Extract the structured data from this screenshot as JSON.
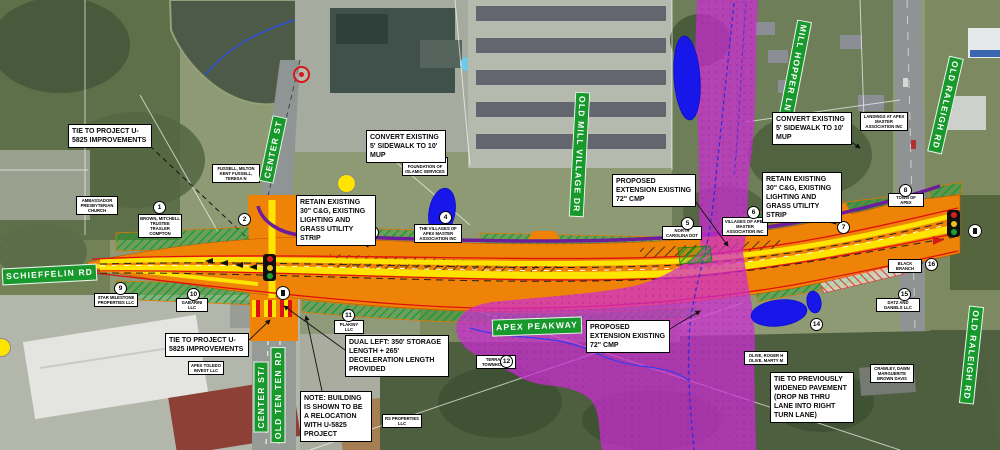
{
  "map": {
    "title": "Apex Peakway Widening Plan",
    "corridor": "APEX PEAKWAY"
  },
  "street_labels": [
    {
      "id": "center-st-north",
      "text": "CENTER ST"
    },
    {
      "id": "schieffelin-rd",
      "text": "SCHIEFFELIN RD"
    },
    {
      "id": "old-mill-village-dr",
      "text": "OLD MILL VILLAGE DR"
    },
    {
      "id": "mill-hopper-ln",
      "text": "MILL HOPPER LN"
    },
    {
      "id": "old-raleigh-rd-north",
      "text": "OLD RALEIGH RD"
    },
    {
      "id": "old-raleigh-rd-south",
      "text": "OLD RALEIGH RD"
    },
    {
      "id": "center-st-south",
      "text": "CENTER ST/"
    },
    {
      "id": "old-ten-ten-rd",
      "text": "OLD TEN TEN RD"
    },
    {
      "id": "apex-peakway",
      "text": "APEX PEAKWAY"
    }
  ],
  "callouts": [
    {
      "id": "tie-u5825-nw",
      "text": "TIE TO PROJECT U-5825 IMPROVEMENTS"
    },
    {
      "id": "convert-sidewalk-west",
      "text": "CONVERT EXISTING 5' SIDEWALK TO 10' MUP"
    },
    {
      "id": "retain-cg-west",
      "text": "RETAIN EXISTING 30\" C&G, EXISTING LIGHTING AND GRASS UTILITY STRIP"
    },
    {
      "id": "proposed-ext-north",
      "text": "PROPOSED EXTENSION EXISTING 72\" CMP"
    },
    {
      "id": "retain-cg-east",
      "text": "RETAIN EXISTING 30\" C&G, EXISTING LIGHTING AND GRASS UTILITY STRIP"
    },
    {
      "id": "convert-sidewalk-east",
      "text": "CONVERT EXISTING 5' SIDEWALK TO 10' MUP"
    },
    {
      "id": "tie-u5825-sw",
      "text": "TIE TO PROJECT U-5825 IMPROVEMENTS"
    },
    {
      "id": "dual-left",
      "text": "DUAL LEFT: 350' STORAGE LENGTH + 265' DECELERATION LENGTH PROVIDED"
    },
    {
      "id": "note-building",
      "text": "NOTE: BUILDING IS SHOWN TO BE A RELOCATION WITH U-5825 PROJECT"
    },
    {
      "id": "proposed-ext-south",
      "text": "PROPOSED EXTENSION EXISTING 72\" CMP"
    },
    {
      "id": "tie-widened",
      "text": "TIE TO PREVIOUSLY WIDENED PAVEMENT (DROP NB THRU LANE INTO RIGHT TURN LANE)"
    }
  ],
  "markers": [
    {
      "n": "1"
    },
    {
      "n": "2"
    },
    {
      "n": "3"
    },
    {
      "n": "4"
    },
    {
      "n": "5"
    },
    {
      "n": "6"
    },
    {
      "n": "7"
    },
    {
      "n": "8"
    },
    {
      "n": "9"
    },
    {
      "n": "10"
    },
    {
      "n": "11"
    },
    {
      "n": "12"
    },
    {
      "n": "13"
    },
    {
      "n": "14"
    },
    {
      "n": "15"
    },
    {
      "n": "16"
    }
  ],
  "parcels": [
    {
      "text": "AMBASSADOR PRESBYTERIAN CHURCH"
    },
    {
      "text": "FUSSELL, MILTON KENT FUSSELL, TERESA N"
    },
    {
      "text": "BROWN, MITCHELL TRUSTEE TRAXLER COMPTON"
    },
    {
      "text": "MADISON REALTY LLC"
    },
    {
      "text": "NORTH AMERICAN FOUNDATION OF ISLAMIC SERVICES"
    },
    {
      "text": "THE VILLAGES OF APEX MASTER ASSOCIATION INC"
    },
    {
      "text": "NORTH CAROLINA DOT"
    },
    {
      "text": "VILLAGES OF APEX MASTER ASSOCIATION INC"
    },
    {
      "text": "TOWN OF APEX"
    },
    {
      "text": "LANDINGS AT APEX MASTER ASSOCIATION INC"
    },
    {
      "text": "BLACK BRANCH"
    },
    {
      "text": "STAR MILESTONE PROPERTIES LLC"
    },
    {
      "text": "GABARINI LLC"
    },
    {
      "text": "PLAKINY LLC"
    },
    {
      "text": "APEX TOLEDO INVEST LLC"
    },
    {
      "text": "RS PROPERTIES LLC"
    },
    {
      "text": "TERRACE TOWNHOMES"
    },
    {
      "text": "OLIVE, ROGER H OLIVE, MARTY M"
    },
    {
      "text": "DATZ AND DANIELS LLC"
    },
    {
      "text": "CRAWLEY, DAWN MARGUERITE BROWN DAVIS"
    }
  ],
  "icons": {
    "traffic_signal": "red-yellow-green signal stack",
    "pedestrian_circle": "white circle crossing symbol",
    "utility_marker": "red circle marker",
    "signal_head": "yellow circle"
  },
  "colors": {
    "proposed_pavement": "#EF8307",
    "resurfacing_yellow": "#FFE400",
    "curb_red": "#E01010",
    "multiuse_path_purple": "#6D1D9A",
    "floodplain_magenta": "#CF2BD6",
    "buffer_hatch_green": "#12A022",
    "pond_blue": "#1717EA",
    "street_label_green": "#17992C"
  }
}
